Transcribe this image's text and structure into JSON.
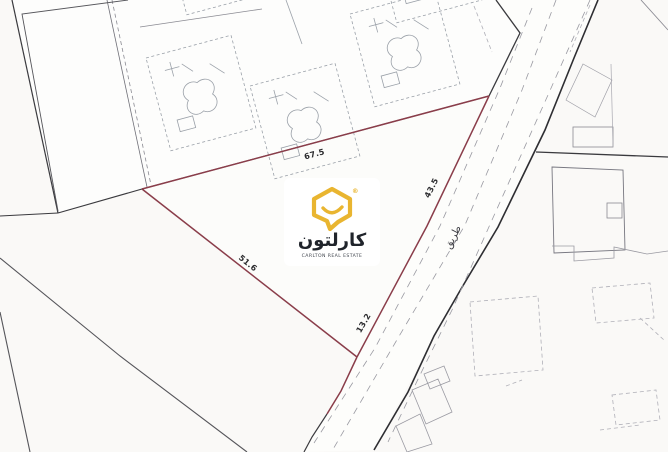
{
  "map": {
    "description": "cadastral site plan of a land plot",
    "dimensions": {
      "top_edge": "67.5",
      "road_edge": "43.5",
      "left_edge": "51.6",
      "bottom_edge": "13.2"
    },
    "road_label": "طريق",
    "plot_outline_color": "#8a3d4a"
  },
  "watermark": {
    "brand_arabic": "كارلتون",
    "brand_english": "CARLTON REAL ESTATE",
    "registered": "®",
    "logo_color": "#e9b530"
  }
}
